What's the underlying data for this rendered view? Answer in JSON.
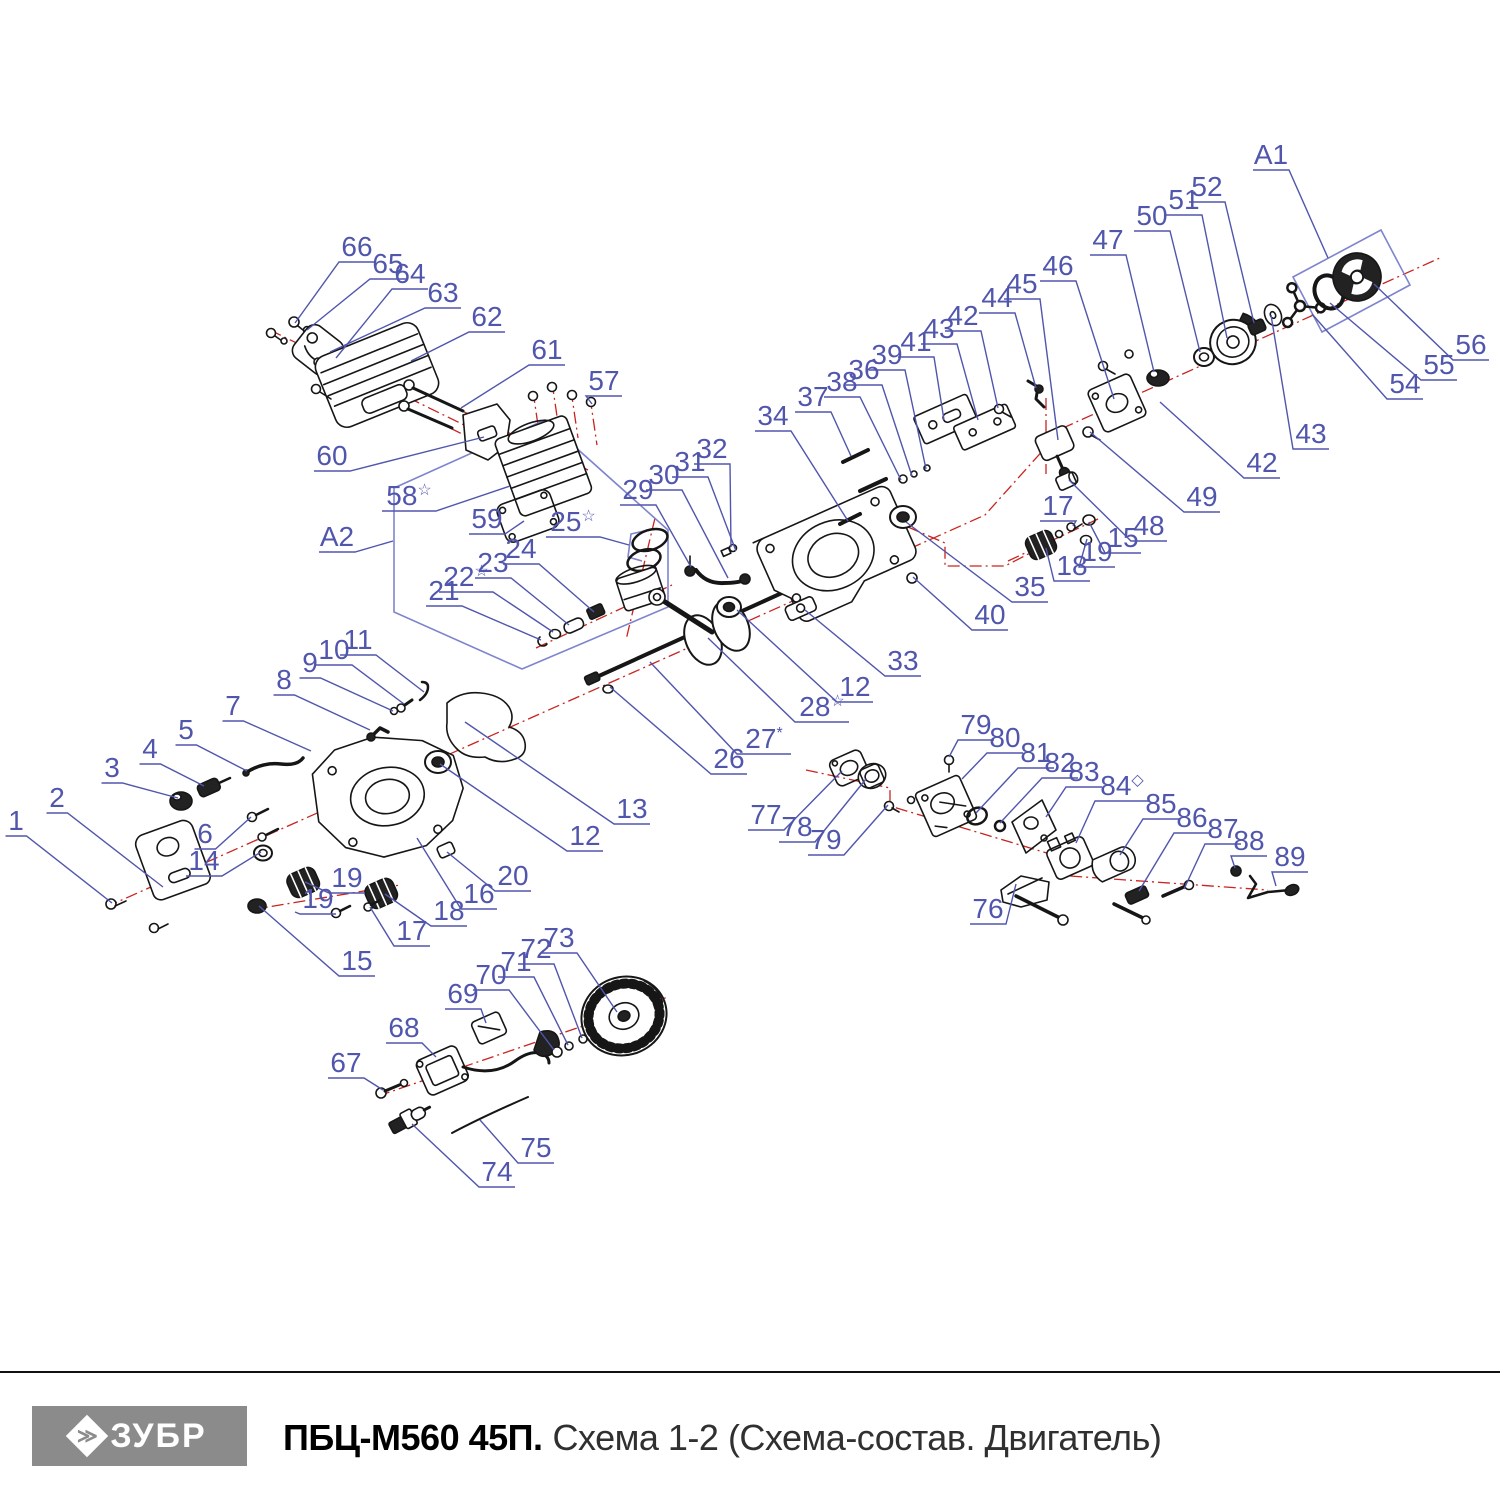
{
  "footer": {
    "brand": "ЗУБР",
    "brand_glyph": "≫",
    "model": "ПБЦ-М560 45П.",
    "subtitle": "Схема 1-2 (Схема-состав. Двигатель)"
  },
  "colors": {
    "label_blue": "#5156ad",
    "box_blue": "#7e84cd",
    "centerline_red": "#c9241f",
    "part_black": "#161616",
    "logo_gray": "#8b8b8b"
  },
  "diagram": {
    "region_boxes": [
      "A1",
      "A2"
    ],
    "labels": [
      {
        "t": "1",
        "x": 16,
        "y": 820,
        "tx": 112,
        "ty": 903
      },
      {
        "t": "2",
        "x": 57,
        "y": 797,
        "tx": 163,
        "ty": 887
      },
      {
        "t": "3",
        "x": 112,
        "y": 767,
        "tx": 178,
        "ty": 798
      },
      {
        "t": "4",
        "x": 150,
        "y": 748,
        "tx": 204,
        "ty": 786
      },
      {
        "t": "5",
        "x": 186,
        "y": 729,
        "tx": 247,
        "ty": 771
      },
      {
        "t": "6",
        "x": 205,
        "y": 833,
        "tx": 251,
        "ty": 817
      },
      {
        "t": "7",
        "x": 233,
        "y": 705,
        "tx": 311,
        "ty": 751
      },
      {
        "t": "8",
        "x": 284,
        "y": 679,
        "tx": 370,
        "ty": 730
      },
      {
        "t": "9",
        "x": 310,
        "y": 662,
        "tx": 393,
        "ty": 711
      },
      {
        "t": "10",
        "x": 334,
        "y": 649,
        "tx": 404,
        "ty": 704
      },
      {
        "t": "11",
        "x": 358,
        "y": 639,
        "tx": 424,
        "ty": 692
      },
      {
        "t": "12",
        "x": 585,
        "y": 835,
        "tx": 440,
        "ty": 764
      },
      {
        "t": "12",
        "x": 855,
        "y": 686,
        "tx": 737,
        "ty": 610
      },
      {
        "t": "13",
        "x": 632,
        "y": 808,
        "tx": 465,
        "ty": 722
      },
      {
        "t": "14",
        "x": 204,
        "y": 860,
        "tx": 261,
        "ty": 852
      },
      {
        "t": "15",
        "x": 357,
        "y": 960,
        "tx": 259,
        "ty": 906
      },
      {
        "t": "15",
        "x": 1123,
        "y": 537,
        "tx": 1089,
        "ty": 522
      },
      {
        "t": "16",
        "x": 479,
        "y": 893,
        "tx": 417,
        "ty": 838
      },
      {
        "t": "17",
        "x": 412,
        "y": 930,
        "tx": 370,
        "ty": 907
      },
      {
        "t": "17",
        "x": 1058,
        "y": 505,
        "tx": 1073,
        "ty": 526
      },
      {
        "t": "18",
        "x": 449,
        "y": 910,
        "tx": 385,
        "ty": 894
      },
      {
        "t": "18",
        "x": 1072,
        "y": 565,
        "tx": 1046,
        "ty": 548
      },
      {
        "t": "19",
        "x": 347,
        "y": 877,
        "tx": 305,
        "ty": 882
      },
      {
        "t": "19",
        "x": 318,
        "y": 898,
        "tx": 295,
        "ty": 912
      },
      {
        "t": "19",
        "x": 1097,
        "y": 551,
        "tx": 1087,
        "ty": 539
      },
      {
        "t": "20",
        "x": 513,
        "y": 875,
        "tx": 447,
        "ty": 852
      },
      {
        "t": "21",
        "x": 444,
        "y": 590,
        "tx": 541,
        "ty": 640
      },
      {
        "t": "22",
        "sup": "☆",
        "x": 466,
        "y": 576,
        "tx": 553,
        "ty": 632
      },
      {
        "t": "23",
        "x": 493,
        "y": 562,
        "tx": 569,
        "ty": 625
      },
      {
        "t": "24",
        "x": 521,
        "y": 548,
        "tx": 594,
        "ty": 612
      },
      {
        "t": "25",
        "sup": "☆",
        "x": 573,
        "y": 521,
        "tx": 629,
        "ty": 545
      },
      {
        "t": "26",
        "x": 729,
        "y": 758,
        "tx": 610,
        "ty": 687
      },
      {
        "t": "27",
        "sup": "*",
        "x": 764,
        "y": 738,
        "tx": 650,
        "ty": 662
      },
      {
        "t": "28",
        "sup": "☆",
        "x": 822,
        "y": 706,
        "tx": 708,
        "ty": 638
      },
      {
        "t": "29",
        "x": 638,
        "y": 489,
        "tx": 691,
        "ty": 567
      },
      {
        "t": "30",
        "x": 664,
        "y": 474,
        "tx": 728,
        "ty": 578
      },
      {
        "t": "31",
        "x": 690,
        "y": 461,
        "tx": 736,
        "ty": 551
      },
      {
        "t": "32",
        "x": 712,
        "y": 448,
        "tx": 731,
        "ty": 547
      },
      {
        "t": "33",
        "x": 903,
        "y": 660,
        "tx": 805,
        "ty": 610
      },
      {
        "t": "34",
        "x": 773,
        "y": 415,
        "tx": 848,
        "ty": 521
      },
      {
        "t": "35",
        "x": 1030,
        "y": 586,
        "tx": 906,
        "ty": 522
      },
      {
        "t": "36",
        "x": 864,
        "y": 369,
        "tx": 912,
        "ty": 476
      },
      {
        "t": "37",
        "x": 813,
        "y": 396,
        "tx": 851,
        "ty": 456
      },
      {
        "t": "38",
        "x": 842,
        "y": 381,
        "tx": 901,
        "ty": 480
      },
      {
        "t": "39",
        "x": 887,
        "y": 354,
        "tx": 926,
        "ty": 469
      },
      {
        "t": "40",
        "x": 990,
        "y": 614,
        "tx": 913,
        "ty": 577
      },
      {
        "t": "41",
        "x": 916,
        "y": 341,
        "tx": 944,
        "ty": 420
      },
      {
        "t": "42",
        "x": 963,
        "y": 315,
        "tx": 998,
        "ty": 408
      },
      {
        "t": "42",
        "x": 1262,
        "y": 462,
        "tx": 1160,
        "ty": 402
      },
      {
        "t": "43",
        "x": 939,
        "y": 328,
        "tx": 978,
        "ty": 420
      },
      {
        "t": "43",
        "x": 1311,
        "y": 433,
        "tx": 1271,
        "ty": 315
      },
      {
        "t": "44",
        "x": 997,
        "y": 297,
        "tx": 1036,
        "ty": 388
      },
      {
        "t": "45",
        "x": 1022,
        "y": 283,
        "tx": 1058,
        "ty": 440
      },
      {
        "t": "46",
        "x": 1058,
        "y": 265,
        "tx": 1114,
        "ty": 399
      },
      {
        "t": "47",
        "x": 1108,
        "y": 239,
        "tx": 1154,
        "ty": 372
      },
      {
        "t": "48",
        "x": 1149,
        "y": 525,
        "tx": 1069,
        "ty": 480
      },
      {
        "t": "49",
        "x": 1202,
        "y": 496,
        "tx": 1090,
        "ty": 432
      },
      {
        "t": "50",
        "x": 1152,
        "y": 215,
        "tx": 1200,
        "ty": 352
      },
      {
        "t": "51",
        "x": 1184,
        "y": 199,
        "tx": 1227,
        "ty": 338
      },
      {
        "t": "52",
        "x": 1207,
        "y": 186,
        "tx": 1254,
        "ty": 323
      },
      {
        "t": "54",
        "x": 1405,
        "y": 383,
        "tx": 1312,
        "ty": 314
      },
      {
        "t": "55",
        "x": 1439,
        "y": 364,
        "tx": 1330,
        "ty": 303
      },
      {
        "t": "56",
        "x": 1471,
        "y": 344,
        "tx": 1374,
        "ty": 284
      },
      {
        "t": "57",
        "x": 604,
        "y": 380,
        "tx": 592,
        "ty": 404
      },
      {
        "t": "58",
        "s up_ignore": "",
        "sup": "☆",
        "x": 409,
        "y": 495,
        "tx": 510,
        "ty": 486
      },
      {
        "t": "59",
        "x": 487,
        "y": 518,
        "tx": 524,
        "ty": 521
      },
      {
        "t": "60",
        "x": 332,
        "y": 455,
        "tx": 484,
        "ty": 437
      },
      {
        "t": "61",
        "x": 547,
        "y": 349,
        "tx": 461,
        "ty": 408
      },
      {
        "t": "62",
        "x": 487,
        "y": 316,
        "tx": 411,
        "ty": 361
      },
      {
        "t": "63",
        "x": 443,
        "y": 292,
        "tx": 330,
        "ty": 352
      },
      {
        "t": "64",
        "x": 410,
        "y": 273,
        "tx": 336,
        "ty": 358
      },
      {
        "t": "65",
        "x": 388,
        "y": 263,
        "tx": 307,
        "ty": 330
      },
      {
        "t": "66",
        "x": 357,
        "y": 246,
        "tx": 295,
        "ty": 323
      },
      {
        "t": "67",
        "x": 346,
        "y": 1062,
        "tx": 383,
        "ty": 1090
      },
      {
        "t": "68",
        "x": 404,
        "y": 1027,
        "tx": 436,
        "ty": 1057
      },
      {
        "t": "69",
        "x": 463,
        "y": 993,
        "tx": 486,
        "ty": 1023
      },
      {
        "t": "70",
        "x": 491,
        "y": 974,
        "tx": 554,
        "ty": 1050
      },
      {
        "t": "71",
        "x": 516,
        "y": 961,
        "tx": 568,
        "ty": 1045
      },
      {
        "t": "72",
        "x": 536,
        "y": 948,
        "tx": 582,
        "ty": 1038
      },
      {
        "t": "73",
        "x": 559,
        "y": 937,
        "tx": 617,
        "ty": 1012
      },
      {
        "t": "74",
        "x": 497,
        "y": 1171,
        "tx": 412,
        "ty": 1124
      },
      {
        "t": "75",
        "x": 536,
        "y": 1147,
        "tx": 480,
        "ty": 1120
      },
      {
        "t": "76",
        "x": 988,
        "y": 908,
        "tx": 1016,
        "ty": 884
      },
      {
        "t": "77",
        "x": 766,
        "y": 814,
        "tx": 842,
        "ty": 771
      },
      {
        "t": "78",
        "x": 797,
        "y": 826,
        "tx": 866,
        "ty": 779
      },
      {
        "t": "79",
        "x": 976,
        "y": 724,
        "tx": 949,
        "ty": 757
      },
      {
        "t": "79",
        "x": 826,
        "y": 839,
        "tx": 888,
        "ty": 805
      },
      {
        "t": "80",
        "x": 1005,
        "y": 737,
        "tx": 962,
        "ty": 779
      },
      {
        "t": "81",
        "x": 1036,
        "y": 752,
        "tx": 976,
        "ty": 813
      },
      {
        "t": "82",
        "x": 1060,
        "y": 762,
        "tx": 1000,
        "ty": 823
      },
      {
        "t": "83",
        "x": 1084,
        "y": 771,
        "tx": 1046,
        "ty": 817
      },
      {
        "t": "84",
        "sup": "◇",
        "x": 1122,
        "y": 785,
        "tx": 1076,
        "ty": 843
      },
      {
        "t": "85",
        "x": 1161,
        "y": 803,
        "tx": 1120,
        "ty": 855
      },
      {
        "t": "86",
        "x": 1192,
        "y": 817,
        "tx": 1139,
        "ty": 891
      },
      {
        "t": "87",
        "x": 1223,
        "y": 828,
        "tx": 1184,
        "ty": 889
      },
      {
        "t": "88",
        "x": 1249,
        "y": 840,
        "tx": 1235,
        "ty": 868
      },
      {
        "t": "89",
        "x": 1290,
        "y": 856,
        "tx": 1276,
        "ty": 886
      },
      {
        "t": "A1",
        "x": 1271,
        "y": 154,
        "tx": 1328,
        "ty": 258
      },
      {
        "t": "A2",
        "x": 337,
        "y": 536,
        "tx": 393,
        "ty": 541
      }
    ]
  }
}
